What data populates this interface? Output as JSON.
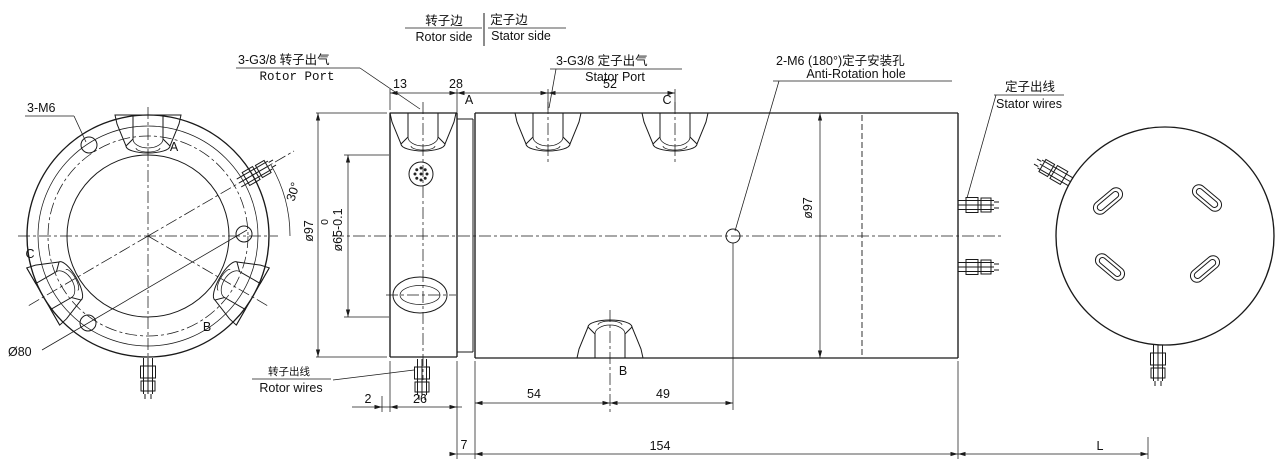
{
  "background": "#ffffff",
  "line_color": "#1a1a1a",
  "header": {
    "rotor_side_zh": "转子边",
    "rotor_side_en": "Rotor side",
    "stator_side_zh": "定子边",
    "stator_side_en": "Stator side"
  },
  "callouts": {
    "rotor_port_zh": "3-G3/8 转子出气",
    "rotor_port_en": "Rotor Port",
    "stator_port_zh": "3-G3/8 定子出气",
    "stator_port_en": "Stator Port",
    "anti_rotation_zh": "2-M6 (180°)定子安装孔",
    "anti_rotation_en": "Anti-Rotation hole",
    "stator_wires_zh": "定子出线",
    "stator_wires_en": "Stator wires",
    "rotor_wires_zh": "转子出线",
    "rotor_wires_en": "Rotor wires",
    "mounting_holes": "3-M6",
    "bolt_circle_dia": "Ø80"
  },
  "dimensions": {
    "flange_thickness": "13",
    "port_a_offset": "28",
    "port_spacing": "52",
    "wire_angle": "30°",
    "flange_od": "ø97",
    "boss_tol_upper": "0",
    "boss_dia": "ø65-0.1",
    "gap": "2",
    "wire_offset": "26",
    "port_b_offset": "54",
    "anti_rotation_offset": "49",
    "body_od": "ø97",
    "step_width": "7",
    "body_length": "154",
    "wire_length": "L"
  },
  "port_labels": {
    "a": "A",
    "b": "B",
    "c": "C"
  }
}
